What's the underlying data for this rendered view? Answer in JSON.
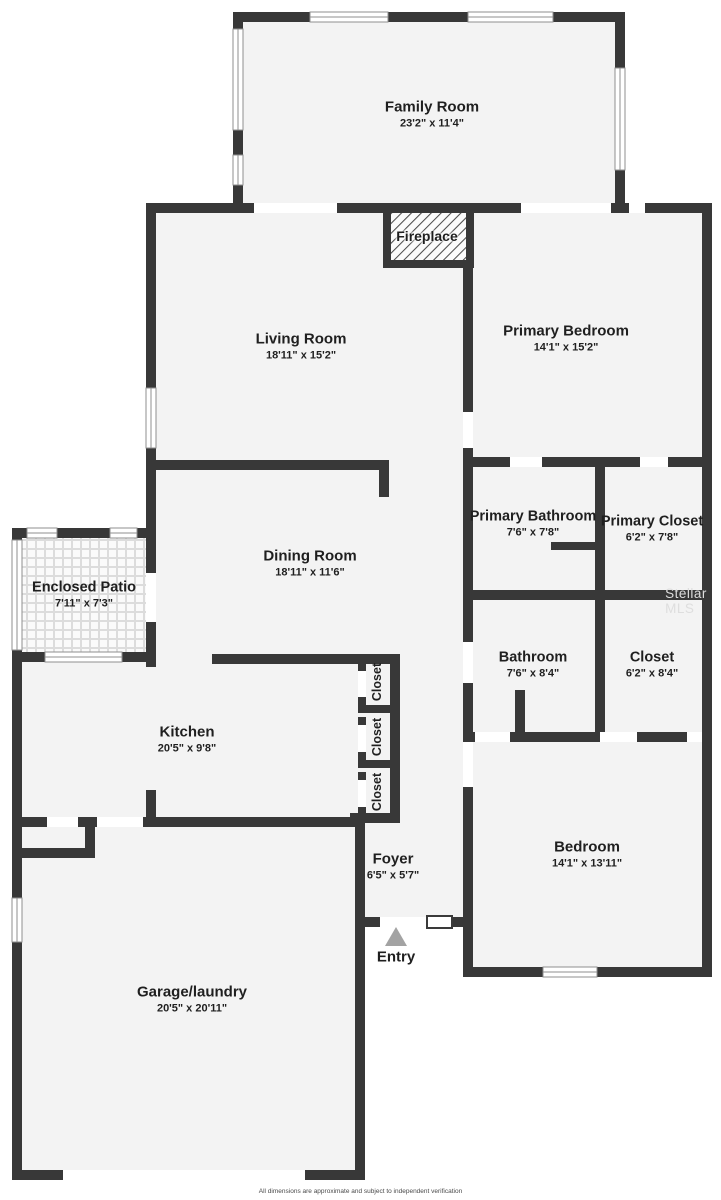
{
  "plan": {
    "watermark": "Stellar MLS",
    "disclaimer": "All dimensions are approximate and subject to independent verification",
    "entry_label": "Entry",
    "colors": {
      "wall": "#383838",
      "floor": "#f3f3f3",
      "window_frame": "#8f8f8f",
      "entry_arrow": "#a3a3a3",
      "watermark_gray": "#dedede"
    },
    "rooms": [
      {
        "id": "family-room",
        "name": "Family Room",
        "dims": "23'2\" x 11'4\""
      },
      {
        "id": "living-room",
        "name": "Living Room",
        "dims": "18'11\" x 15'2\""
      },
      {
        "id": "primary-bedroom",
        "name": "Primary Bedroom",
        "dims": "14'1\" x 15'2\""
      },
      {
        "id": "fireplace",
        "name": "Fireplace",
        "dims": ""
      },
      {
        "id": "primary-bathroom",
        "name": "Primary Bathroom",
        "dims": "7'6\" x 7'8\""
      },
      {
        "id": "primary-closet",
        "name": "Primary Closet",
        "dims": "6'2\" x 7'8\""
      },
      {
        "id": "dining-room",
        "name": "Dining Room",
        "dims": "18'11\" x 11'6\""
      },
      {
        "id": "enclosed-patio",
        "name": "Enclosed Patio",
        "dims": "7'11\" x 7'3\""
      },
      {
        "id": "bathroom",
        "name": "Bathroom",
        "dims": "7'6\" x 8'4\""
      },
      {
        "id": "closet-hall",
        "name": "Closet",
        "dims": "6'2\" x 8'4\""
      },
      {
        "id": "kitchen",
        "name": "Kitchen",
        "dims": "20'5\" x 9'8\""
      },
      {
        "id": "closet-1",
        "name": "Closet",
        "dims": ""
      },
      {
        "id": "closet-2",
        "name": "Closet",
        "dims": ""
      },
      {
        "id": "closet-3",
        "name": "Closet",
        "dims": ""
      },
      {
        "id": "foyer",
        "name": "Foyer",
        "dims": "6'5\" x 5'7\""
      },
      {
        "id": "bedroom",
        "name": "Bedroom",
        "dims": "14'1\" x 13'11\""
      },
      {
        "id": "garage",
        "name": "Garage/laundry",
        "dims": "20'5\" x 20'11\""
      }
    ]
  }
}
